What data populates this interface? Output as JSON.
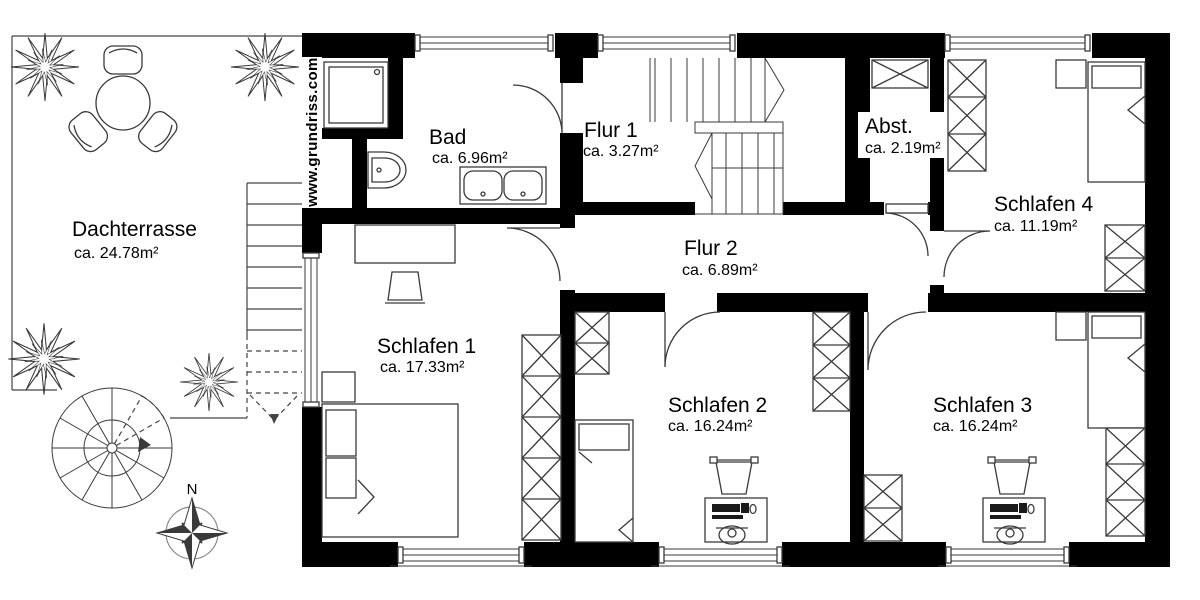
{
  "watermark": "www.grundriss.com",
  "compass": {
    "north_label": "N"
  },
  "rooms": [
    {
      "id": "dachterrasse",
      "name": "Dachterrasse",
      "area": "ca. 24.78m²"
    },
    {
      "id": "bad",
      "name": "Bad",
      "area": "ca. 6.96m²"
    },
    {
      "id": "flur-1",
      "name": "Flur 1",
      "area": "ca. 3.27m²"
    },
    {
      "id": "abstellraum",
      "name": "Abst.",
      "area": "ca. 2.19m²"
    },
    {
      "id": "schlafen-4",
      "name": "Schlafen 4",
      "area": "ca. 11.19m²"
    },
    {
      "id": "flur-2",
      "name": "Flur 2",
      "area": "ca. 6.89m²"
    },
    {
      "id": "schlafen-1",
      "name": "Schlafen 1",
      "area": "ca. 17.33m²"
    },
    {
      "id": "schlafen-2",
      "name": "Schlafen 2",
      "area": "ca. 16.24m²"
    },
    {
      "id": "schlafen-3",
      "name": "Schlafen 3",
      "area": "ca. 16.24m²"
    }
  ],
  "colors": {
    "wall": "#000000",
    "furniture_line": "#3a3a3a",
    "background": "#ffffff"
  }
}
